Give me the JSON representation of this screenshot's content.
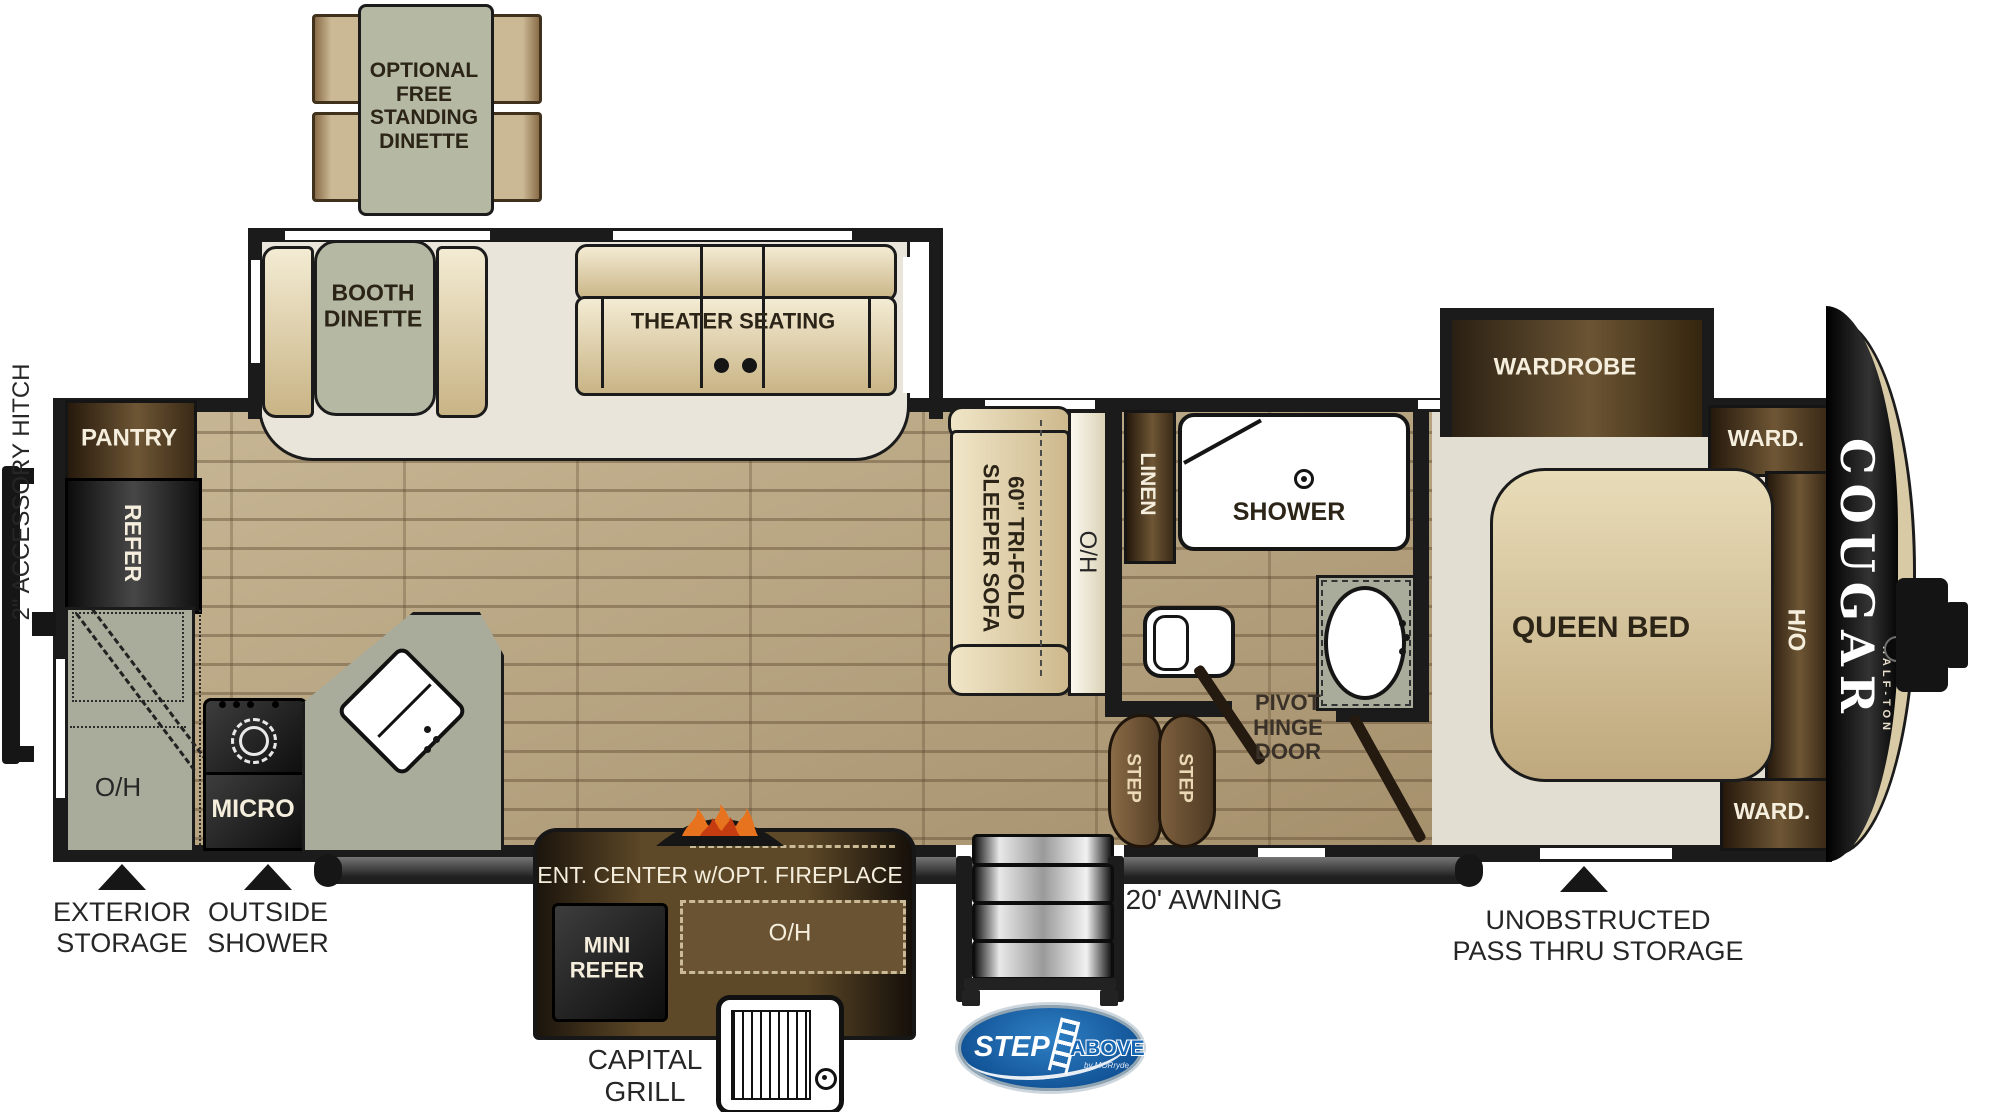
{
  "title": "Cougar Half-Ton fifth wheel RV floorplan",
  "palette": {
    "wall": "#1b1b1b",
    "wood_floor": "#b7a485",
    "slide_floor": "#e9e5da",
    "bedroom_floor": "#e3ded2",
    "cushion_tan": "#d9c79c",
    "table_green": "#b5b9a4",
    "cabinet_brown": "#5d4827",
    "counter_sage": "#a9ac9a",
    "step_brown": "#6f5639",
    "awning_gray": "#3c3c3c",
    "logo_blue": "#1767b3",
    "flame_orange": "#e8731f"
  },
  "labels": {
    "accessory_hitch": "2\" ACCESSORY HITCH",
    "free_standing_dinette": "OPTIONAL\nFREE\nSTANDING\nDINETTE",
    "booth_dinette": "BOOTH\nDINETTE",
    "theater_seating": "THEATER SEATING",
    "pantry": "PANTRY",
    "refer": "REFER",
    "kitchen_oh": "O/H",
    "micro": "MICRO",
    "exterior_storage": "EXTERIOR\nSTORAGE",
    "outside_shower": "OUTSIDE\nSHOWER",
    "sleeper_sofa": "60\" TRI-FOLD\nSLEEPER SOFA",
    "sofa_oh": "O/H",
    "linen": "LINEN",
    "shower": "SHOWER",
    "pivot_hinge_door": "PIVOT\nHINGE\nDOOR",
    "step_1": "STEP",
    "step_2": "STEP",
    "ent_center": "ENT. CENTER w/OPT. FIREPLACE",
    "mini_refer": "MINI\nREFER",
    "ent_oh": "O/H",
    "capital_grill": "CAPITAL\nGRILL",
    "awning": "20' AWNING",
    "wardrobe_slide": "WARDROBE",
    "ward_top": "WARD.",
    "ward_bottom": "WARD.",
    "ho": "H/O",
    "queen_bed": "QUEEN BED",
    "pass_thru": "UNOBSTRUCTED\nPASS THRU STORAGE",
    "brand": "COUGAR",
    "brand_sub": "HALF-TON",
    "logo_step": "STEP",
    "logo_above": "ABOVE",
    "logo_byline": "by MORryde"
  }
}
